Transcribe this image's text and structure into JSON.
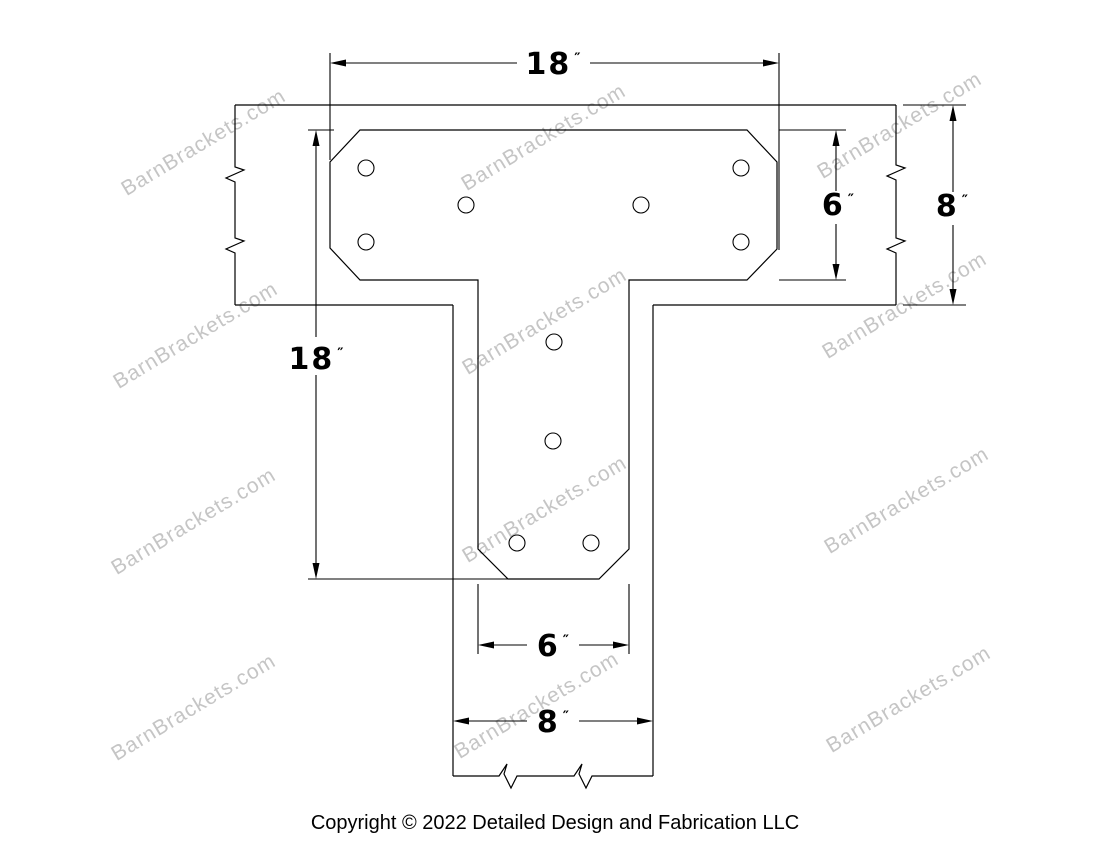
{
  "page": {
    "background": "#ffffff",
    "line_color": "#000000",
    "watermark_color": "#c5c5c5"
  },
  "watermark": {
    "text": "BarnBrackets.com"
  },
  "dimensions": {
    "top_width": {
      "value": "18",
      "unit": "″"
    },
    "plate_height": {
      "value": "6",
      "unit": "″"
    },
    "beam_height": {
      "value": "8",
      "unit": "″"
    },
    "stem_length": {
      "value": "18",
      "unit": "″"
    },
    "stem_plate_width": {
      "value": "6",
      "unit": "″"
    },
    "stem_beam_width": {
      "value": "8",
      "unit": "″"
    }
  },
  "footer": {
    "copyright": "Copyright © 2022 Detailed Design and Fabrication LLC"
  }
}
